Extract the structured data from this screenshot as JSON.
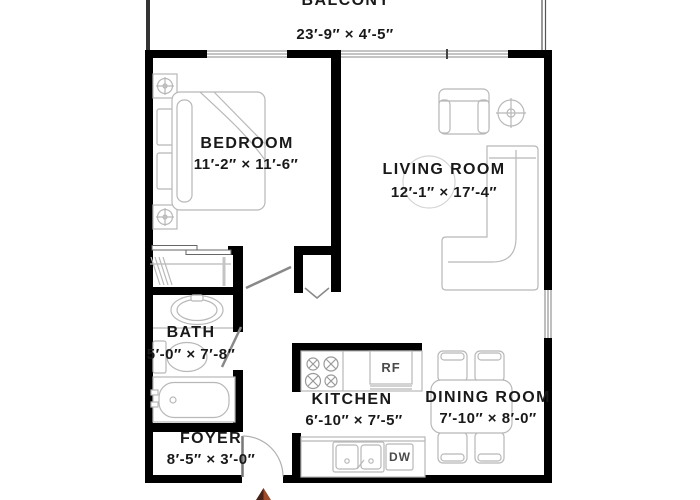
{
  "plan": {
    "rooms": {
      "balcony": {
        "name": "BALCONY",
        "dims": "23′-9″ ×  4′-5″"
      },
      "bedroom": {
        "name": "BEDROOM",
        "dims": "11′-2″ ×  11′-6″"
      },
      "living_room": {
        "name": "LIVING ROOM",
        "dims": "12′-1″ ×  17′-4″"
      },
      "bath": {
        "name": "BATH",
        "dims": "5′-0″ × 7′-8″"
      },
      "kitchen": {
        "name": "KITCHEN",
        "dims": "6′-10″ ×  7′-5″"
      },
      "dining_room": {
        "name": "DINING ROOM",
        "dims": "7′-10″ ×  8′-0″"
      },
      "foyer": {
        "name": "FOYER",
        "dims": "8′-5″  ×  3′-0″"
      }
    },
    "appliances": {
      "refrigerator": "RF",
      "dishwasher": "DW"
    },
    "colors": {
      "wall": "#000000",
      "furniture_line": "#b8b8b8",
      "label_text": "#191919",
      "north_arrow_dark": "#46231a",
      "north_arrow_light": "#a04a28"
    }
  }
}
